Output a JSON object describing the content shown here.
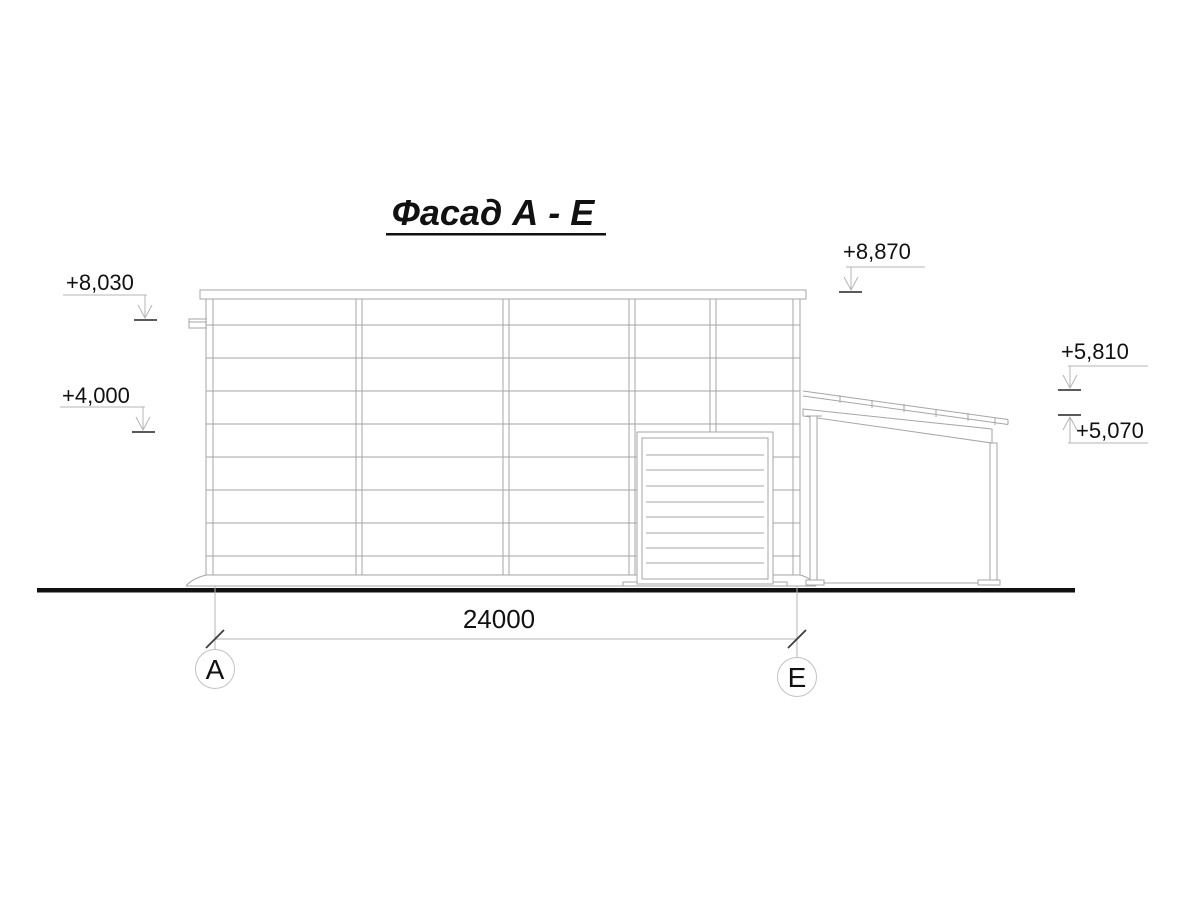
{
  "title": {
    "text": "Фасад А - Е"
  },
  "levels": {
    "l8030": "+8,030",
    "l4000": "+4,000",
    "l8870": "+8,870",
    "l5810": "+5,810",
    "l5070": "+5,070"
  },
  "dimension": {
    "span": "24000"
  },
  "axes": {
    "left": "А",
    "right": "Е"
  },
  "colors": {
    "drawing_line": "#a6a6a6",
    "text": "#111111",
    "ground_line": "#111111",
    "level_tick": "#5a5a5a"
  }
}
